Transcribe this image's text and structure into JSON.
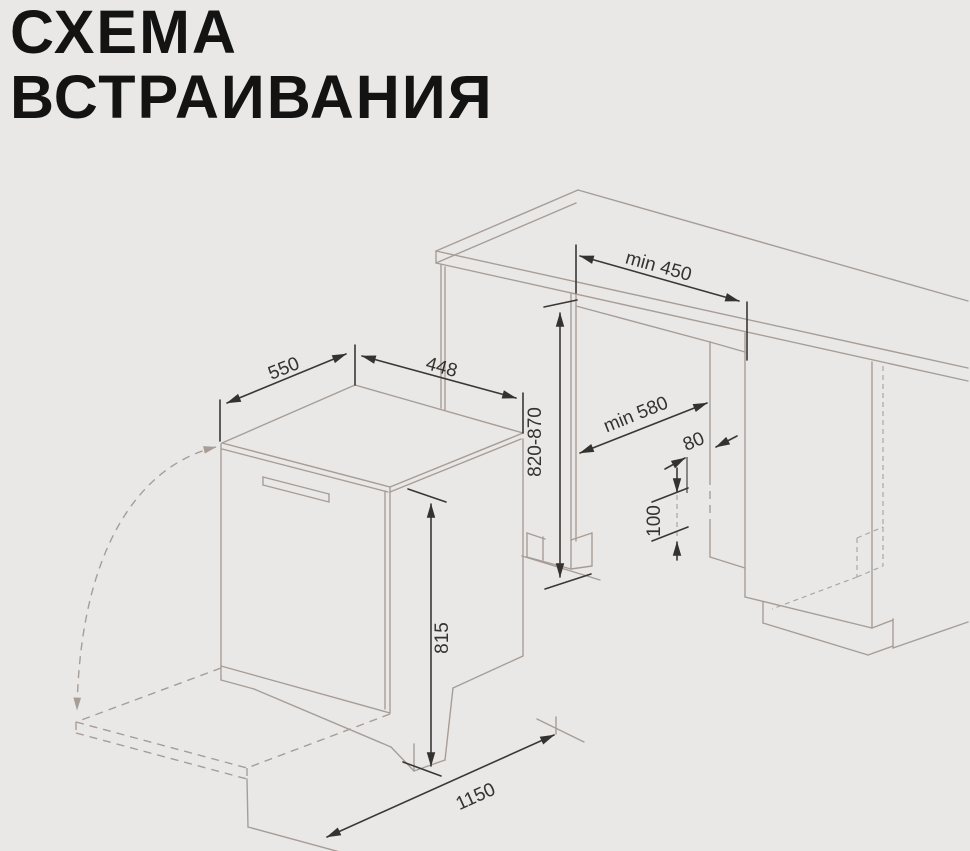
{
  "title": {
    "line1": "СХЕМА",
    "line2": "ВСТРАИВАНИЯ"
  },
  "diagram": {
    "type": "appliance-built-in-installation-scheme",
    "appliance": "dishwasher",
    "dimensions": {
      "top_depth": "550",
      "top_width": "448",
      "niche_width": "min 450",
      "niche_height": "820-870",
      "niche_depth": "min 580",
      "service_zone_depth": "80",
      "service_zone_height": "100",
      "appliance_height": "815",
      "depth_with_door_open": "1150"
    },
    "colors": {
      "background": "#e9e8e6",
      "furniture_outline": "#a89d96",
      "dimension_ink": "#3b3734",
      "title_ink": "#131313"
    }
  }
}
